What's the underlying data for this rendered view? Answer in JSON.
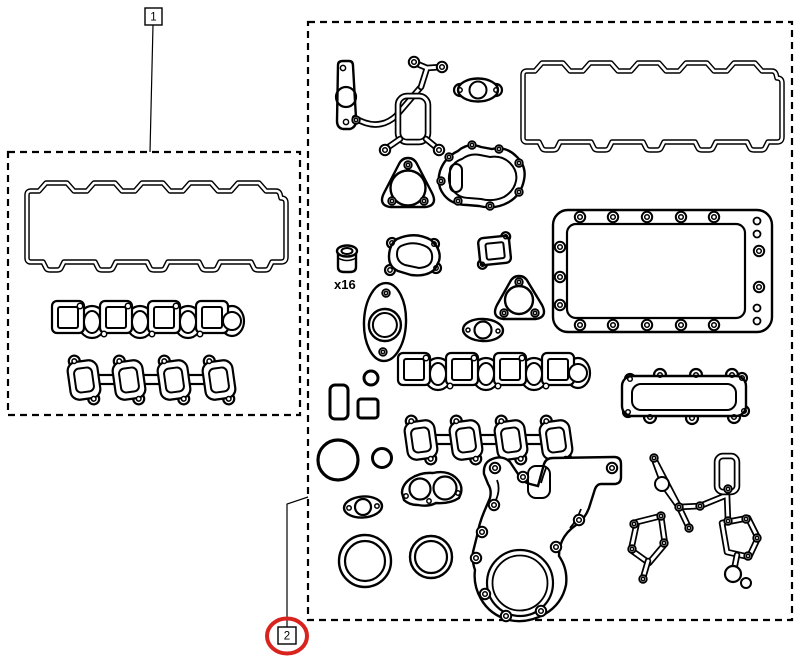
{
  "diagram": {
    "type": "engine-gasket-kit-parts-diagram",
    "background": "#ffffff",
    "line_color": "#000000",
    "highlight_color": "#d9231f",
    "callouts": [
      {
        "label": "1",
        "highlighted": false
      },
      {
        "label": "2",
        "highlighted": true
      }
    ],
    "annotations": {
      "valve_stem_seal_count": "x16"
    },
    "groups": [
      {
        "callout": "1",
        "parts": [
          "valve-cover-gasket",
          "intake-manifold-gasket",
          "exhaust-manifold-gasket"
        ]
      },
      {
        "callout": "2",
        "parts": [
          "front-cover-gasket",
          "water-outlet-oval-gasket",
          "valve-cover-gasket",
          "thermostat-housing-gasket",
          "water-pump-gasket",
          "valve-stem-seal-x16",
          "outlet-elbow-gasket",
          "small-port-gasket",
          "oil-pan-gasket",
          "exhaust-flange-gasket",
          "round-port-gasket",
          "oval-two-bolt-gasket",
          "intake-manifold-gasket",
          "oil-cooler-cover-gasket",
          "o-ring-small",
          "rectangular-seal",
          "square-seal",
          "exhaust-manifold-gasket",
          "o-ring-large",
          "o-ring-medium",
          "twin-port-gasket",
          "oval-two-bolt-gasket-2",
          "crankshaft-seal-large",
          "crankshaft-seal-small",
          "timing-cover-gasket",
          "side-cover-gasket"
        ]
      }
    ]
  }
}
